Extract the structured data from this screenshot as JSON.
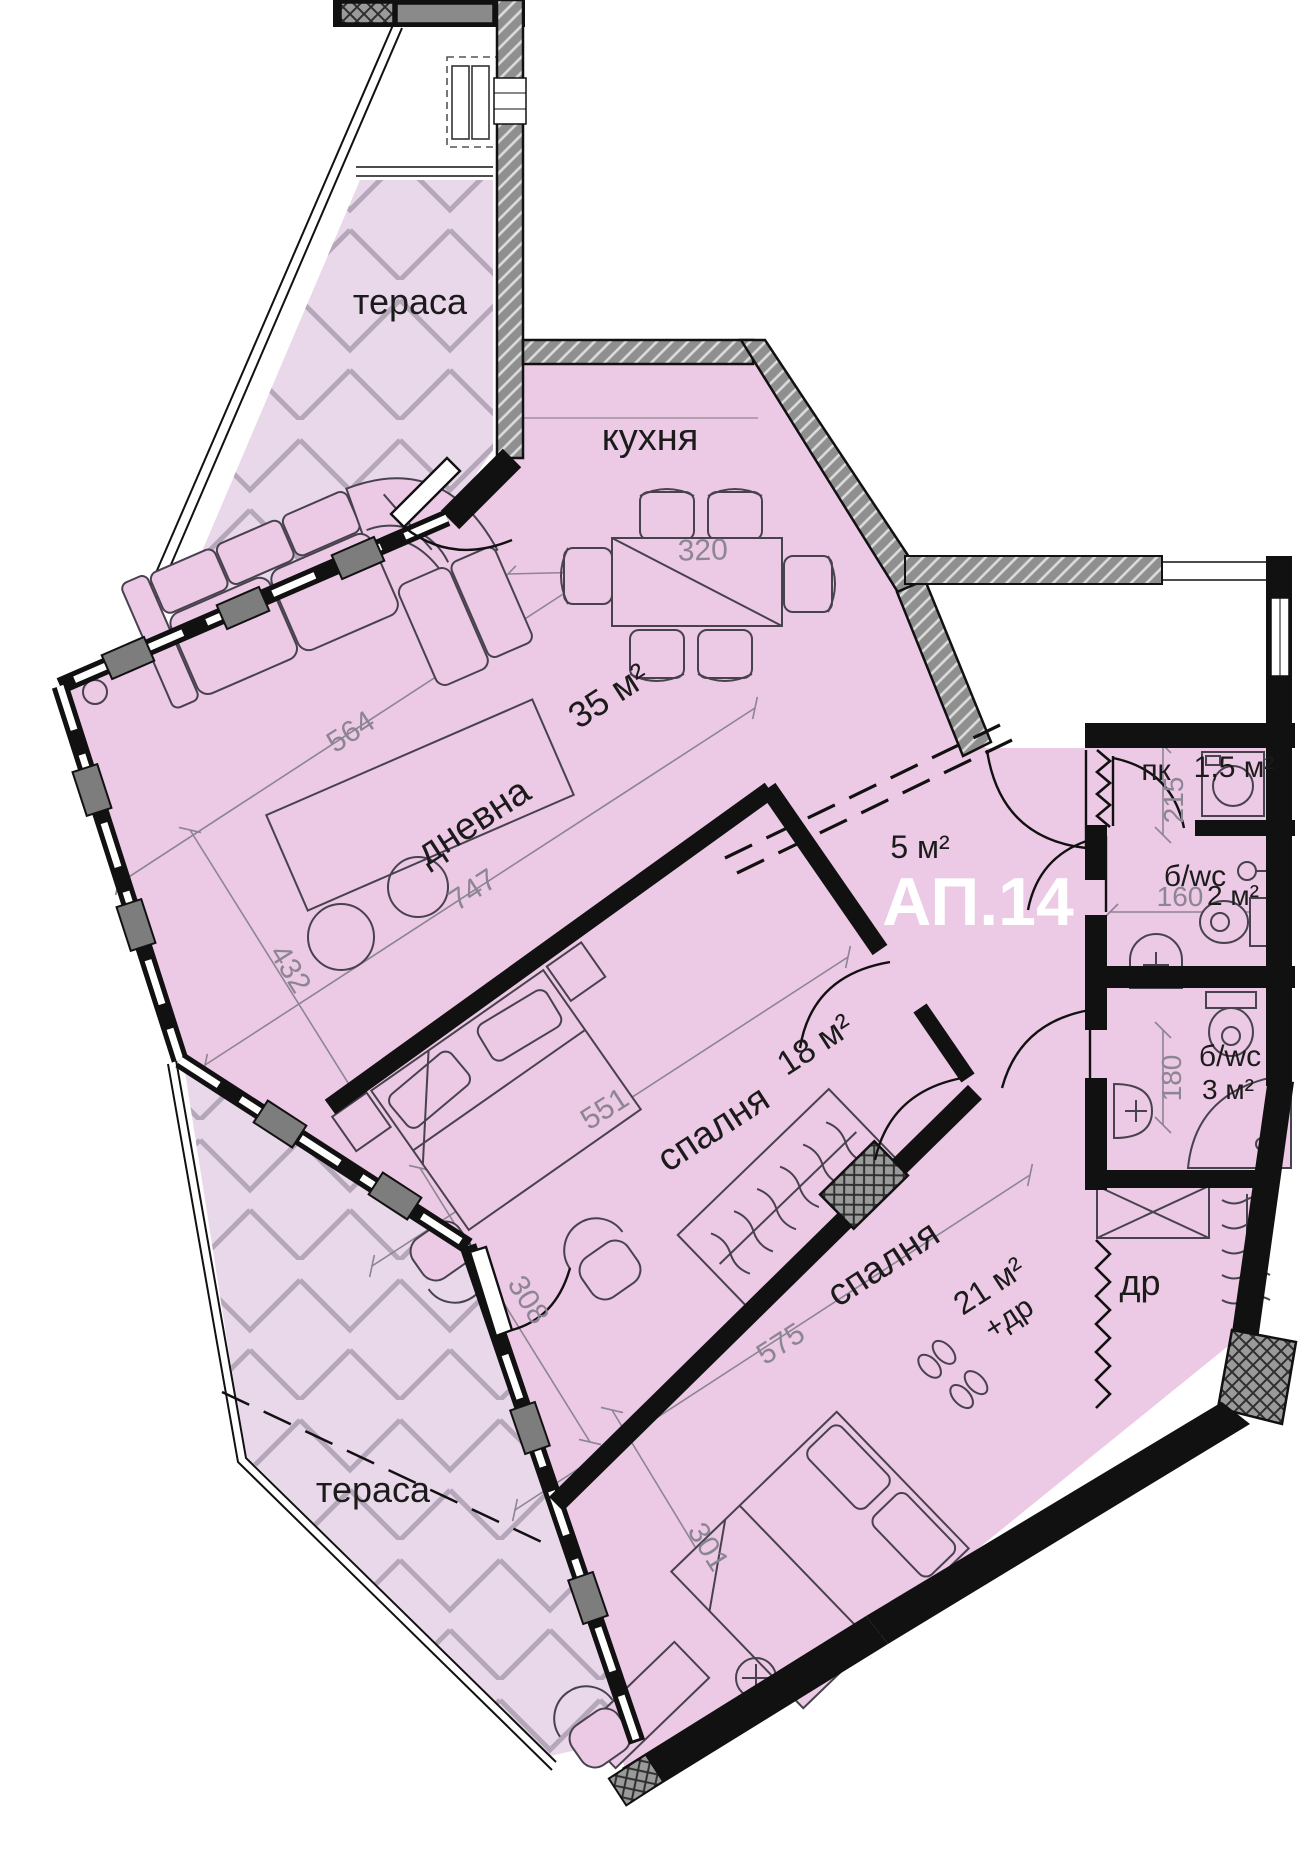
{
  "plan": {
    "unit_number": "АП.14",
    "labels": {
      "terrace_top": "тераса",
      "terrace_bottom": "тераса",
      "kitchen": "кухня",
      "living": "дневна",
      "bedroom1": "спалня",
      "bedroom2": "спалня",
      "storage": "пк",
      "bath1": "б/wc",
      "bath2": "б/wc",
      "closet": "др"
    },
    "areas": {
      "living_kitchen": "35 м²",
      "hall": "5 м²",
      "bedroom1": "18 м²",
      "bedroom2": "21 м²",
      "bedroom2_note": "+др",
      "storage": "1,5 м²",
      "bath1": "2 м²",
      "bath2": "3 м²"
    },
    "dimensions_cm": {
      "kitchen_table": "320",
      "living_width": "564",
      "living_length": "747",
      "living_depth": "432",
      "bedroom1_length": "551",
      "bedroom1_width": "308",
      "bedroom2_length": "575",
      "bedroom2_width": "301",
      "storage_depth": "215",
      "bath1_width": "160",
      "bath2_depth": "180"
    },
    "rooms": [
      {
        "label": "тераса"
      },
      {
        "label": "кухня"
      },
      {
        "label": "дневна",
        "area": "35 м²"
      },
      {
        "area": "5 м²"
      },
      {
        "label": "пк",
        "area": "1,5 м²"
      },
      {
        "label": "б/wc",
        "area": "2 м²"
      },
      {
        "label": "б/wc",
        "area": "3 м²"
      },
      {
        "label": "др"
      },
      {
        "label": "спалня",
        "area": "18 м²"
      },
      {
        "label": "спалня",
        "area": "21 м²",
        "note": "+др"
      },
      {
        "label": "тераса"
      }
    ],
    "colors": {
      "interior": "#ecc9e4",
      "terrace": "#e9d8e9",
      "wall": "#111111",
      "wall_hatch": "#8f8f8f",
      "dimension_text": "#8c8593",
      "unit_text": "#ffffff"
    }
  }
}
